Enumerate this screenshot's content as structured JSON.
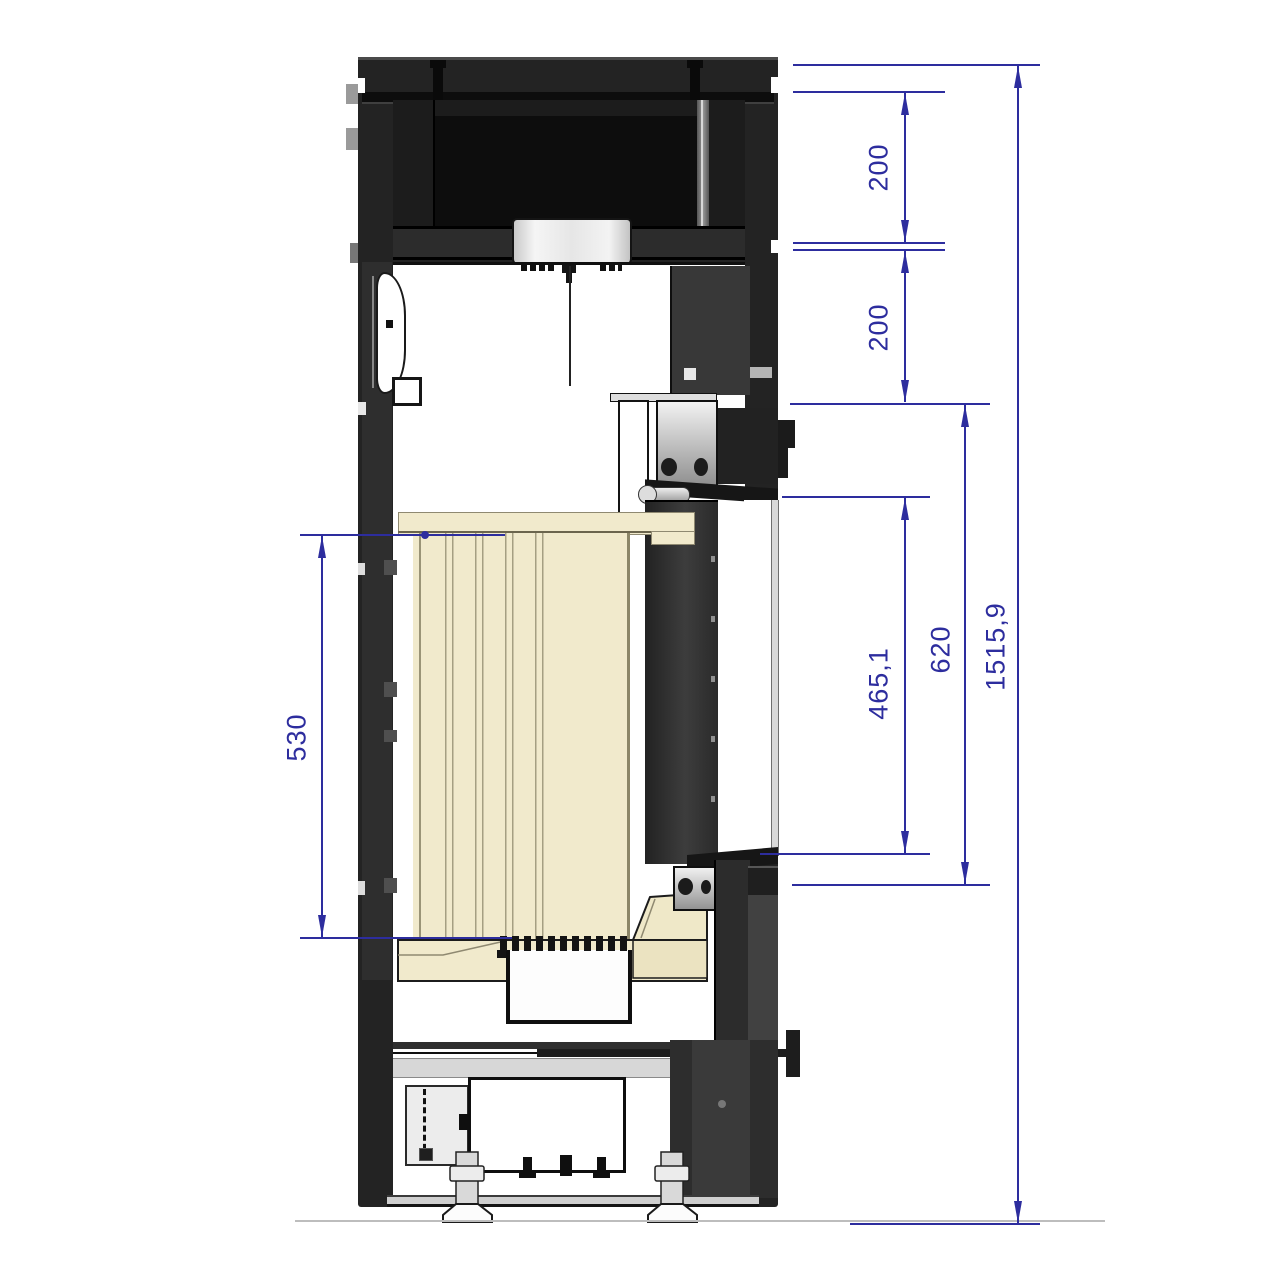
{
  "drawing": {
    "type": "technical_section_drawing",
    "subject": "wood-stove vertical cross-section with height dimensions",
    "units_style": "millimeters, decimal comma",
    "dimensions": [
      {
        "id": "top-section-height",
        "value": "200",
        "orientation": "vertical",
        "side": "right"
      },
      {
        "id": "upper-section-height",
        "value": "200",
        "orientation": "vertical",
        "side": "right"
      },
      {
        "id": "glass-opening-height",
        "value": "465,1",
        "orientation": "vertical",
        "side": "right"
      },
      {
        "id": "door-opening-height",
        "value": "620",
        "orientation": "vertical",
        "side": "right"
      },
      {
        "id": "firebox-lining-height",
        "value": "530",
        "orientation": "vertical",
        "side": "left"
      },
      {
        "id": "overall-height",
        "value": "1515,9",
        "orientation": "vertical",
        "side": "right"
      }
    ],
    "colors": {
      "dimension_blue": "#2d2d9e",
      "body_dark": "#232323",
      "firebrick_cream": "#f1eacc",
      "metal_light": "#e8e8e8",
      "background": "#ffffff"
    }
  }
}
